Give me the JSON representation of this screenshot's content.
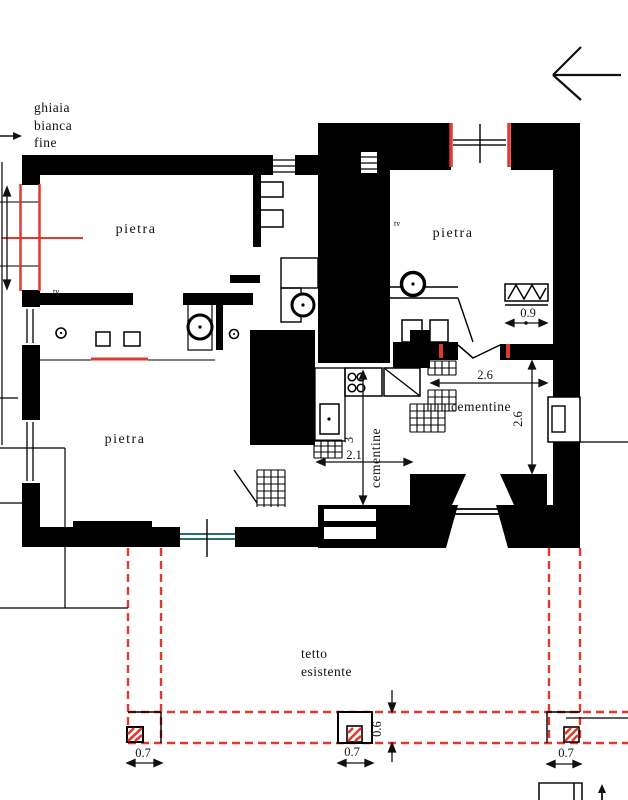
{
  "drawing": {
    "annotations": {
      "gravel_note_line1": "ghiaia",
      "gravel_note_line2": "bianca",
      "gravel_note_line3": "fine",
      "roof_note_line1": "tetto",
      "roof_note_line2": "esistente",
      "tv_left": "tv",
      "tv_right": "tv"
    },
    "rooms": {
      "top_left": "pietra",
      "top_right": "pietra",
      "bottom_left": "pietra",
      "dining": "cementine",
      "kitchen_floor": "cementine"
    },
    "dimensions": {
      "radiator": "0.9",
      "dining_width": "2.6",
      "dining_depth": "2.6",
      "kitchen_width": "2.1",
      "kitchen_depth": "3",
      "pillar_left": "0.7",
      "pillar_middle": "0.7",
      "pillar_right": "0.7",
      "roof_edge": "0.6"
    },
    "colors": {
      "walls": "#000000",
      "accent_red": "#e0392e",
      "window_teal": "#2a6e6e",
      "paper": "#ffffff"
    }
  }
}
